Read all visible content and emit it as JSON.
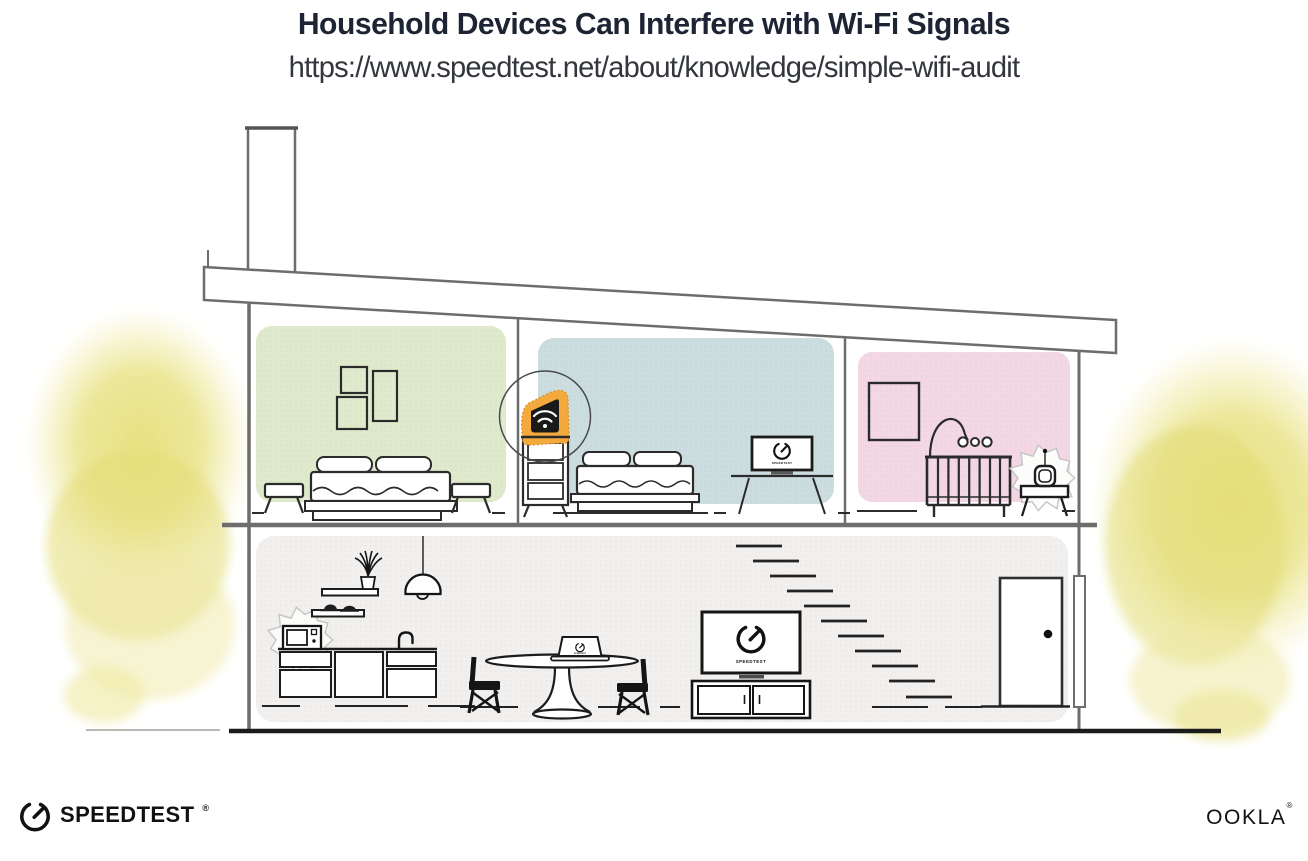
{
  "header": {
    "title": "Household Devices Can Interfere with Wi-Fi Signals",
    "url": "https://www.speedtest.net/about/knowledge/simple-wifi-audit"
  },
  "branding": {
    "speedtest": "SPEEDTEST",
    "speedtest_reg": "®",
    "ookla": "OOKLA",
    "ookla_reg": "®"
  },
  "screens": {
    "living_tv_caption": "SPEEDTEST",
    "bedroom_tv_caption": "SPEEDTEST",
    "laptop_caption": "SPEEDTEST"
  },
  "colors": {
    "green_wall": "#dfe9cb",
    "blue_wall": "#ccdde0",
    "pink_wall": "#f3d7e5",
    "floor_panel": "#f1f0ee",
    "highlight_orange": "#f4a93c",
    "bush_yellow": "#e7e17e",
    "title_ink": "#1d2433",
    "structure_gray": "#6d6d6d"
  },
  "scene": {
    "rooms": [
      "bedroom-green",
      "bedroom-blue",
      "nursery-pink",
      "kitchen-living-area"
    ],
    "devices": [
      "wifi-router",
      "bedroom-tv",
      "baby-monitor",
      "microwave",
      "dining-laptop",
      "living-room-tv"
    ]
  }
}
